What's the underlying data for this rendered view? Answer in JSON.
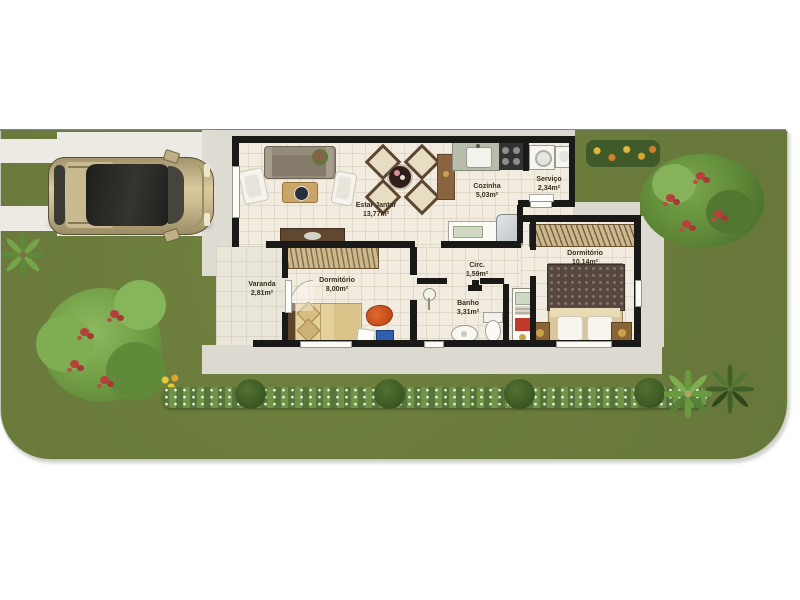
{
  "plan": {
    "type": "residential-floor-plan",
    "rooms": [
      {
        "name": "Estar Jantar",
        "area": "13,77m²"
      },
      {
        "name": "Cozinha",
        "area": "5,03m²"
      },
      {
        "name": "Serviço",
        "area": "2,34m²"
      },
      {
        "name": "Dormitório",
        "area": "10,14m²"
      },
      {
        "name": "Dormitório",
        "area": "8,00m²"
      },
      {
        "name": "Varanda",
        "area": "2,81m²"
      },
      {
        "name": "Circ.",
        "area": "1,59m²"
      },
      {
        "name": "Banho",
        "area": "3,31m²"
      }
    ],
    "palette": {
      "lawn_green": "#6b7c3c",
      "floor_beige": "#f1ecdf",
      "wall_black": "#191917",
      "concrete_gray": "#dbd9d0",
      "flower_red": "#b5403c",
      "car_champagne": "#c9ba90"
    }
  }
}
